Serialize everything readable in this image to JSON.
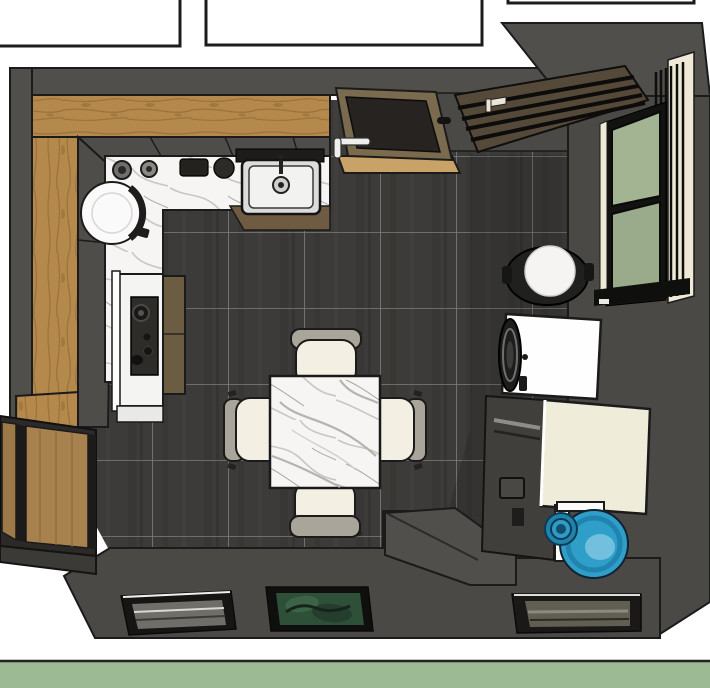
{
  "scene": {
    "type": "3d-interior-top-down-render",
    "room": "kitchen-dining-room",
    "objects": [
      "adjacent-room-outline-left",
      "adjacent-room-outline-middle",
      "adjacent-room-outline-right",
      "tiled-floor",
      "top-wall",
      "left-wall",
      "right-wall",
      "bottom-wall",
      "wall-step-block",
      "wood-countertop-top",
      "wood-countertop-left",
      "base-cabinets-top",
      "base-cabinets-left",
      "marble-countertop",
      "counter-front-panel",
      "round-basin",
      "counter-jars",
      "range-hood-shadow",
      "kitchen-sink",
      "faucet",
      "entry-door-top",
      "louvered-panel-door",
      "side-window",
      "window-blinds",
      "window-curtain",
      "round-stool",
      "washing-machine",
      "dark-appliance",
      "cream-cabinet",
      "water-jug-stand",
      "water-jug",
      "dining-table",
      "chair-north",
      "chair-south",
      "chair-west",
      "chair-east",
      "range-cooktop",
      "tall-wood-cabinet",
      "sliding-door-left",
      "floor-vent-left",
      "plant-opening-middle",
      "floor-vent-right",
      "ground-strip"
    ]
  },
  "palette": {
    "background": "#ffffff",
    "outline": "#1b1b1b",
    "wall": "#4a4945",
    "wall_top": "#504f4c",
    "wall_dark": "#413f3c",
    "floor_tile": "#3c3b39",
    "tile_grout": "#8f8f8c",
    "wood_counter": "#b5894c",
    "wood_grain": "#97713c",
    "dark_wood": "#554a39",
    "marble": "#f6f5f3",
    "marble_vein": "#b5b3af",
    "cabinet": "#4e4d49",
    "counter_front_wood": "#6e5b41",
    "steel": "#dcdcda",
    "chair_seat": "#f3efe2",
    "chair_back": "#a9a59a",
    "appliance_white": "#fefefe",
    "appliance_dark": "#413f3c",
    "cabinet_cream": "#efecda",
    "water_jug_blue": "#2f9fca",
    "water_jug_blue_dark": "#1a79a2",
    "window_glass": "#a3b493",
    "window_glass_low": "#9aab8c",
    "curtain": "#efe9d6",
    "ground_band_green": "#9cba93",
    "plant": "#2e4f38",
    "plant_light": "#3c6345"
  }
}
